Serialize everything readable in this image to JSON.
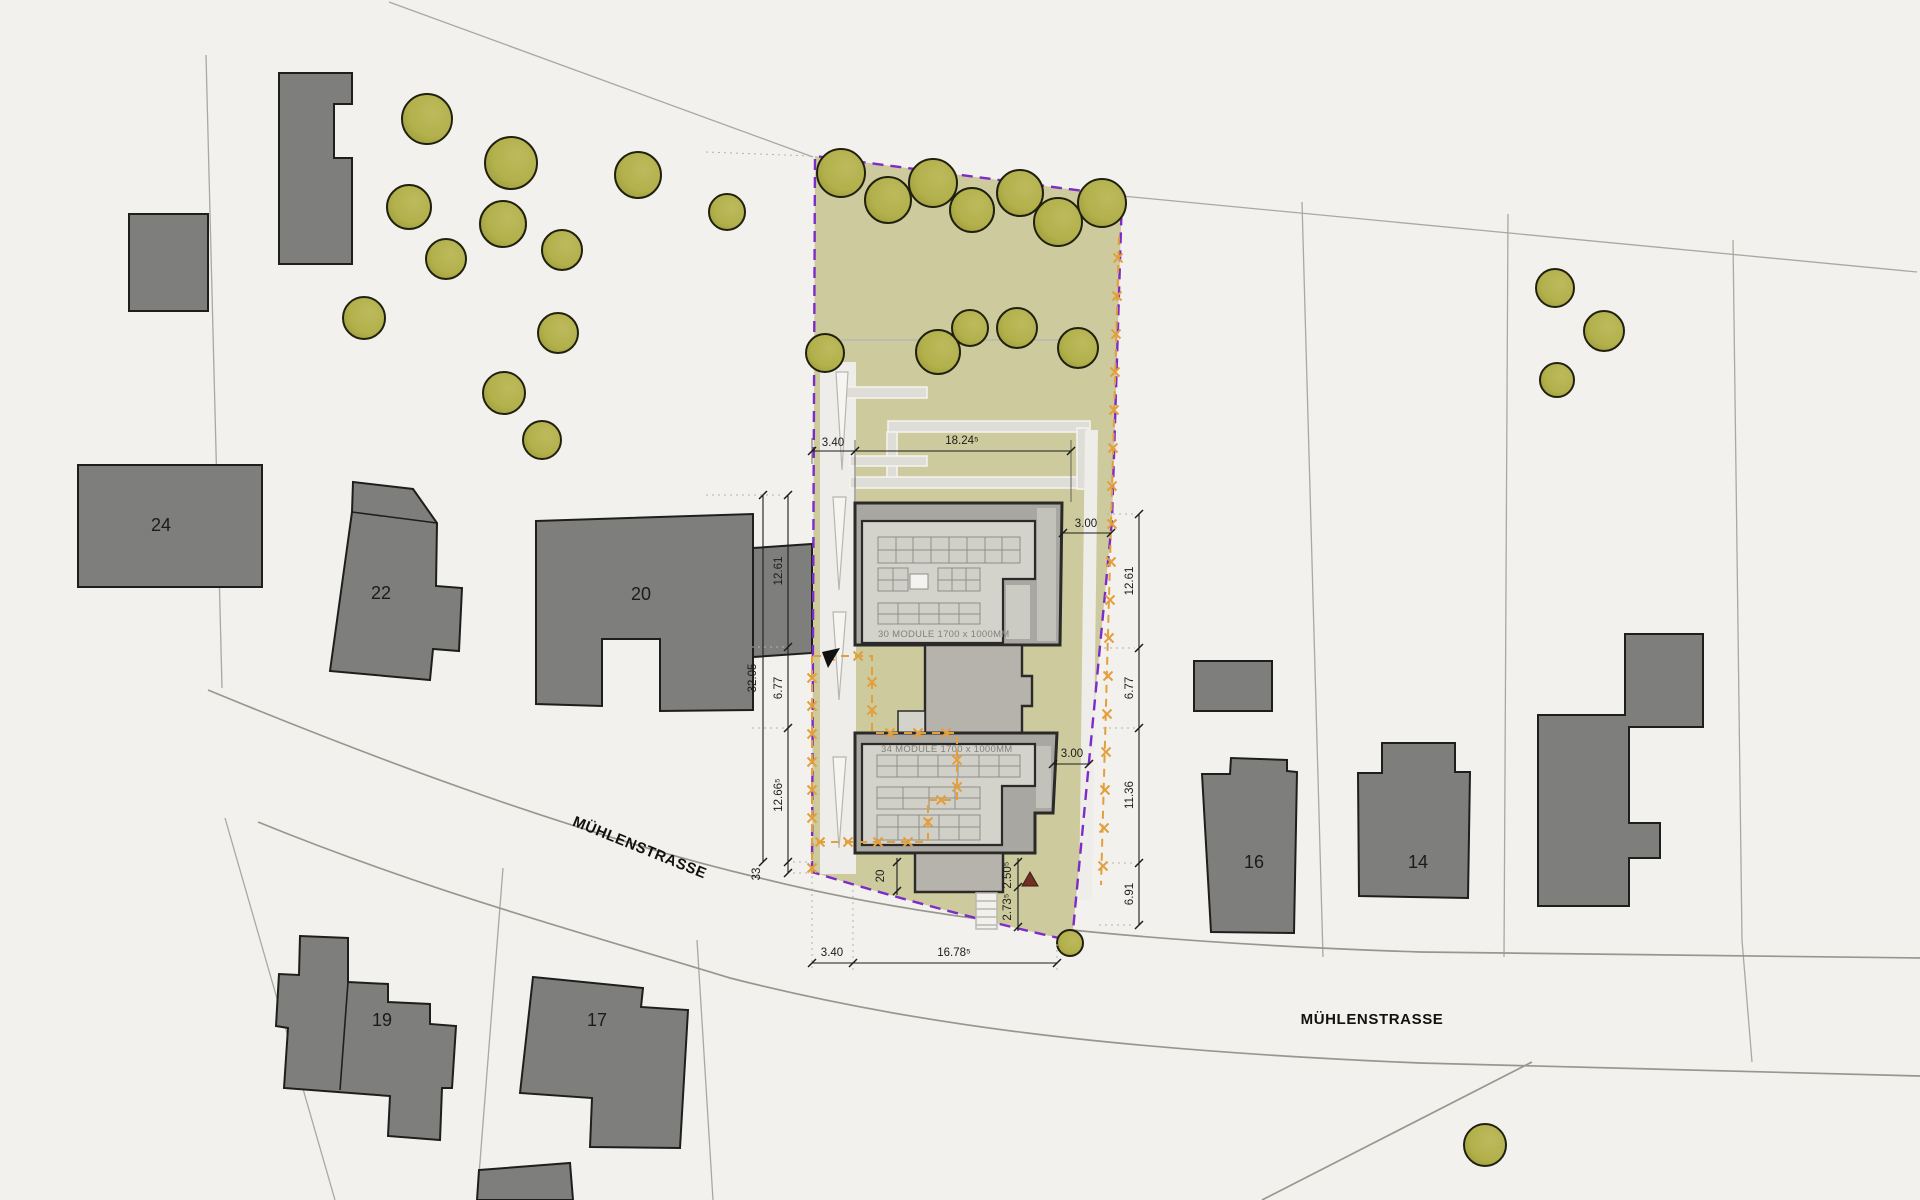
{
  "plan": {
    "streets": {
      "street_diagonal": "MÜHLENSTRASSE",
      "street_bottom": "MÜHLENSTRASSE"
    },
    "houses": [
      {
        "label": "24"
      },
      {
        "label": "22"
      },
      {
        "label": "20"
      },
      {
        "label": "19"
      },
      {
        "label": "17"
      },
      {
        "label": "16"
      },
      {
        "label": "14"
      }
    ],
    "new_buildings": {
      "upper_label": "30 MODULE 1700 x 1000MM",
      "lower_label": "34 MODULE 1700 x 1000MM"
    },
    "dimensions": {
      "top_offset": "3.40",
      "top_width": "18.24⁵",
      "left_total": "32.05",
      "left_seg1": "12.61",
      "left_seg2": "6.77",
      "left_seg3": "12.66⁵",
      "left_seg4": "33",
      "right_seg1": "12.61",
      "right_seg2": "6.77",
      "right_seg3": "11.36",
      "right_seg4": "6.91",
      "gap_upper": "3.00",
      "gap_lower": "3.00",
      "bottom_offset": "3.40",
      "bottom_width": "16.78⁵",
      "entry_seg1": "2.50⁵",
      "entry_seg2": "2.73⁵",
      "wall_thickness": "20"
    },
    "colors": {
      "background": "#f2f1ed",
      "plot_green": "#cdcb9d",
      "boundary_purple": "#7c2cc8",
      "fence_orange": "#e39f3c",
      "house_gray": "#7e7e7c",
      "new_building_gray": "#a9a7a1",
      "module_panel": "#d3d2cb",
      "tree_olive": "#b3b14c",
      "dimension_black": "#1c1c1c",
      "street_text": "#111111"
    }
  }
}
